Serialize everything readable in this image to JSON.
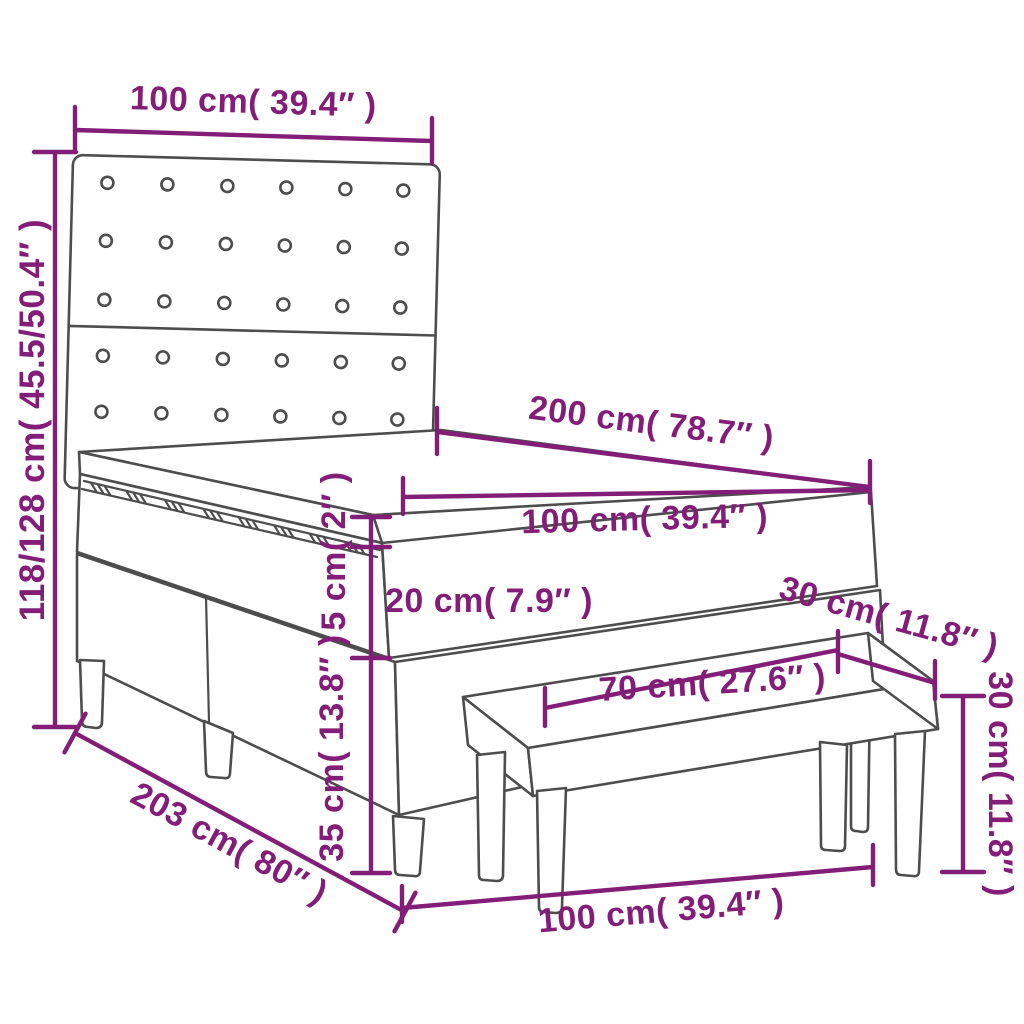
{
  "diagram": {
    "title": "box-spring-bed-with-bench-dimension-diagram",
    "accent_color": "#831E78",
    "line_color": "#4D4D4D",
    "labels": {
      "headboard_width": "100 cm( 39.4″ )",
      "overall_height": "118/128 cm( 45.5/50.4″ )",
      "bed_length": "200 cm( 78.7″ )",
      "mattress_width": "100 cm( 39.4″ )",
      "topper_thickness": "5 cm( 2″ )",
      "mattress_thickness": "20 cm( 7.9″ )",
      "base_height": "35 cm( 13.8″ )",
      "overall_length": "203 cm( 80″ )",
      "bench_length": "100 cm( 39.4″ )",
      "bench_seat_length": "70 cm( 27.6″ )",
      "bench_depth": "30 cm( 11.8″ )",
      "bench_height": "30 cm( 11.8″ )"
    },
    "parts": [
      "headboard",
      "mattress-topper",
      "mattress",
      "box-spring-base",
      "bench"
    ]
  }
}
